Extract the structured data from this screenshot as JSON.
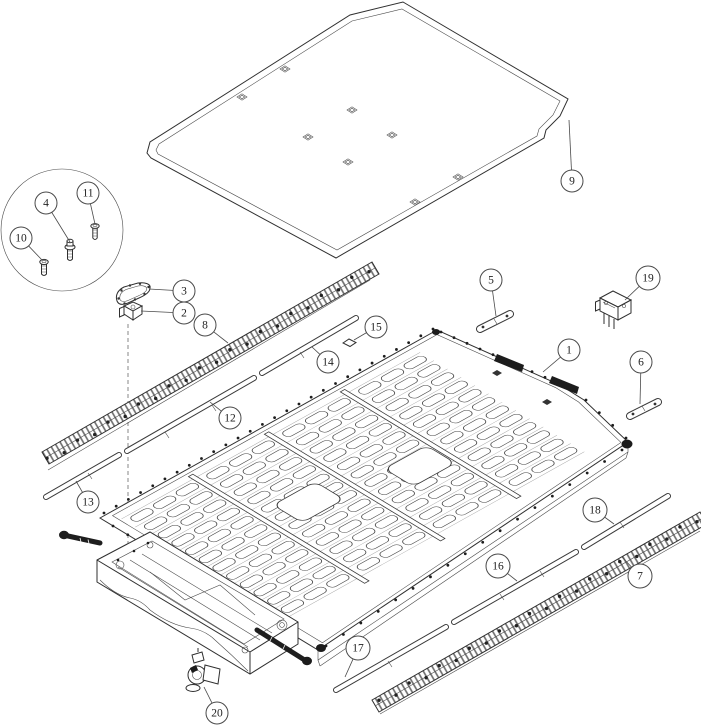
{
  "document": {
    "kind": "exploded-parts-diagram",
    "background": "#ffffff",
    "ink": "#2f2f2f",
    "callout_fill": "#ffffff",
    "callout_stroke": "#4a4a4a",
    "callout_text_color": "#222222"
  },
  "callouts": [
    {
      "label": "1",
      "cx": 569,
      "cy": 350,
      "r": 11,
      "tx": 543,
      "ty": 372
    },
    {
      "label": "2",
      "cx": 184,
      "cy": 313,
      "r": 11,
      "tx": 141,
      "ty": 311
    },
    {
      "label": "3",
      "cx": 184,
      "cy": 291,
      "r": 11,
      "tx": 149,
      "ty": 289
    },
    {
      "label": "4",
      "cx": 46,
      "cy": 203,
      "r": 11,
      "tx": 70,
      "ty": 242
    },
    {
      "label": "5",
      "cx": 491,
      "cy": 280,
      "r": 11,
      "tx": 496,
      "ty": 316
    },
    {
      "label": "6",
      "cx": 641,
      "cy": 362,
      "r": 11,
      "tx": 640,
      "ty": 404
    },
    {
      "label": "7",
      "cx": 640,
      "cy": 576,
      "r": 12,
      "tx": 622,
      "ty": 557
    },
    {
      "label": "8",
      "cx": 205,
      "cy": 325,
      "r": 11,
      "tx": 228,
      "ty": 343
    },
    {
      "label": "9",
      "cx": 572,
      "cy": 181,
      "r": 11,
      "tx": 569,
      "ty": 120
    },
    {
      "label": "10",
      "cx": 21,
      "cy": 238,
      "r": 11,
      "tx": 42,
      "ty": 260
    },
    {
      "label": "11",
      "cx": 88,
      "cy": 193,
      "r": 11,
      "tx": 95,
      "ty": 224
    },
    {
      "label": "12",
      "cx": 230,
      "cy": 418,
      "r": 11,
      "tx": 210,
      "ty": 402
    },
    {
      "label": "13",
      "cx": 88,
      "cy": 502,
      "r": 11,
      "tx": 76,
      "ty": 481
    },
    {
      "label": "14",
      "cx": 328,
      "cy": 362,
      "r": 11,
      "tx": 312,
      "ty": 347
    },
    {
      "label": "15",
      "cx": 376,
      "cy": 327,
      "r": 11,
      "tx": 354,
      "ty": 340
    },
    {
      "label": "16",
      "cx": 498,
      "cy": 566,
      "r": 12,
      "tx": 517,
      "ty": 581
    },
    {
      "label": "17",
      "cx": 358,
      "cy": 648,
      "r": 12,
      "tx": 345,
      "ty": 677
    },
    {
      "label": "18",
      "cx": 595,
      "cy": 510,
      "r": 12,
      "tx": 614,
      "ty": 524
    },
    {
      "label": "19",
      "cx": 648,
      "cy": 278,
      "r": 12,
      "tx": 625,
      "ty": 300
    },
    {
      "label": "20",
      "cx": 217,
      "cy": 713,
      "r": 11,
      "tx": 204,
      "ty": 687
    }
  ]
}
